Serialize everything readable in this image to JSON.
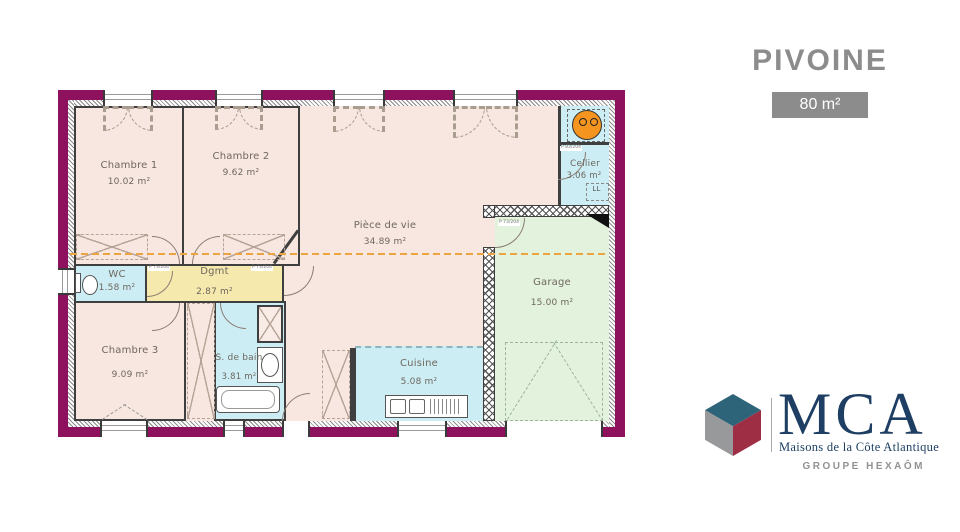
{
  "header": {
    "title": "PIVOINE",
    "area_badge": "80 m²"
  },
  "rooms": [
    {
      "id": "chambre1",
      "label": "Chambre 1",
      "area": "10.02 m²"
    },
    {
      "id": "chambre2",
      "label": "Chambre 2",
      "area": "9.62 m²"
    },
    {
      "id": "piece_de_vie",
      "label": "Pièce de vie",
      "area": "34.89 m²"
    },
    {
      "id": "cellier",
      "label": "Cellier",
      "area": "3.06 m²"
    },
    {
      "id": "garage",
      "label": "Garage",
      "area": "15.00 m²"
    },
    {
      "id": "wc",
      "label": "WC",
      "area": "1.58 m²"
    },
    {
      "id": "dgmt",
      "label": "Dgmt",
      "area": "2.87 m²"
    },
    {
      "id": "chambre3",
      "label": "Chambre 3",
      "area": "9.09 m²"
    },
    {
      "id": "sdb",
      "label": "S. de bain",
      "area": "3.81 m²"
    },
    {
      "id": "cuisine",
      "label": "Cuisine",
      "area": "5.08 m²"
    }
  ],
  "labels": {
    "p73": "P 73/204",
    "p83": "P 83/204",
    "ll": "LL"
  },
  "brand": {
    "name": "MCA",
    "tagline": "Maisons de la Côte Atlantique",
    "group": "GROUPE HEXAÔM"
  },
  "colors": {
    "wall": "#8e115e",
    "room_pink": "#f8e7e1",
    "room_blue": "#cdedf4",
    "room_yellow": "#f6e9ae",
    "room_green": "#e3f2dc",
    "accent_orange": "#eba43f"
  }
}
